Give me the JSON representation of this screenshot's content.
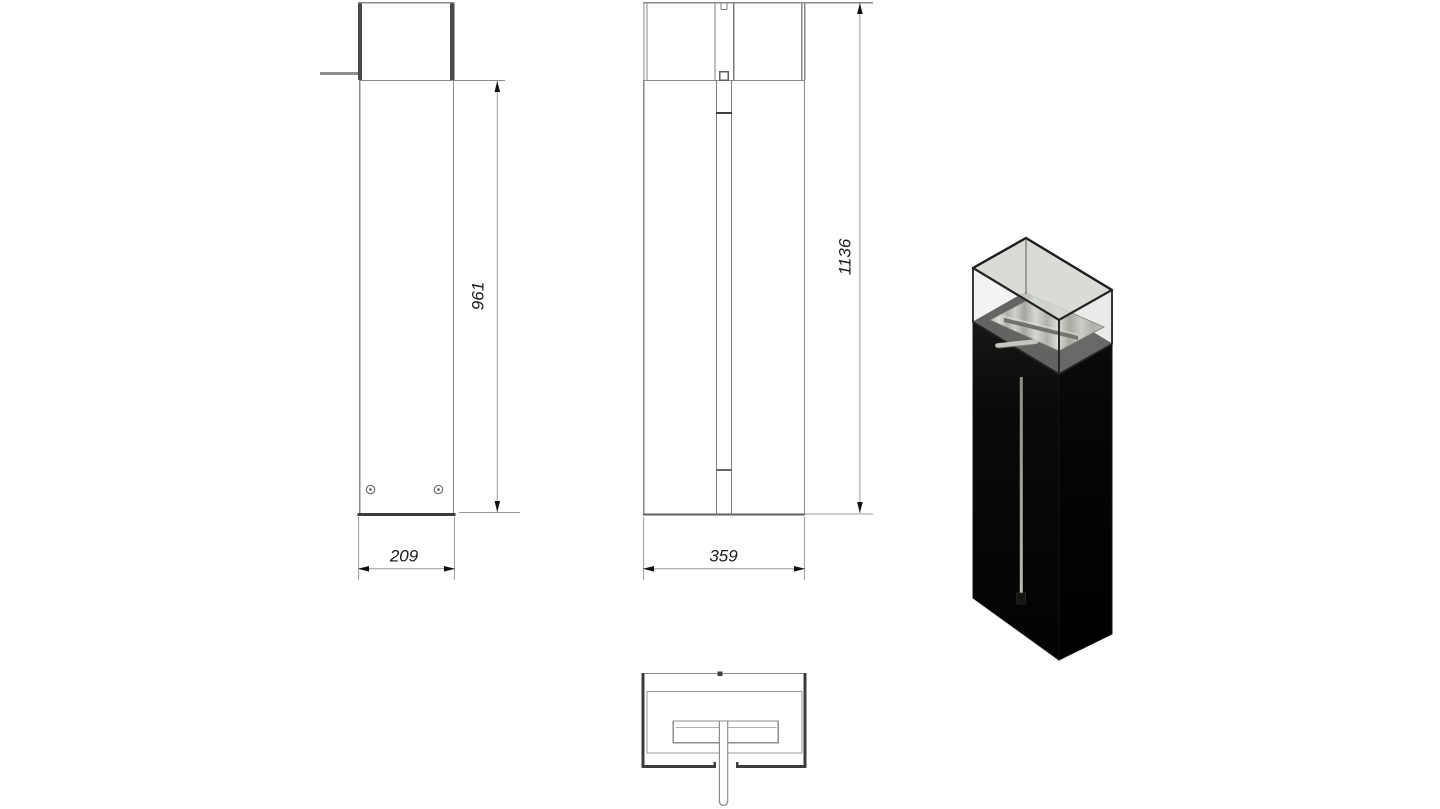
{
  "drawing": {
    "dimensions": {
      "side_height": "961",
      "side_width": "209",
      "front_height": "1136",
      "front_width": "359"
    },
    "colors": {
      "background": "#ffffff",
      "thin_line": "#8a8a8a",
      "thick_line": "#3c3c3c",
      "dimension_line": "#9a9a9a",
      "arrow": "#111111",
      "dimension_text": "#1a1a1a",
      "render_body_black": "#101010",
      "render_glass_tint": "#d4d7d1",
      "render_steel_deck": "#b0b0a8",
      "render_rod": "#c6c6c0"
    }
  }
}
